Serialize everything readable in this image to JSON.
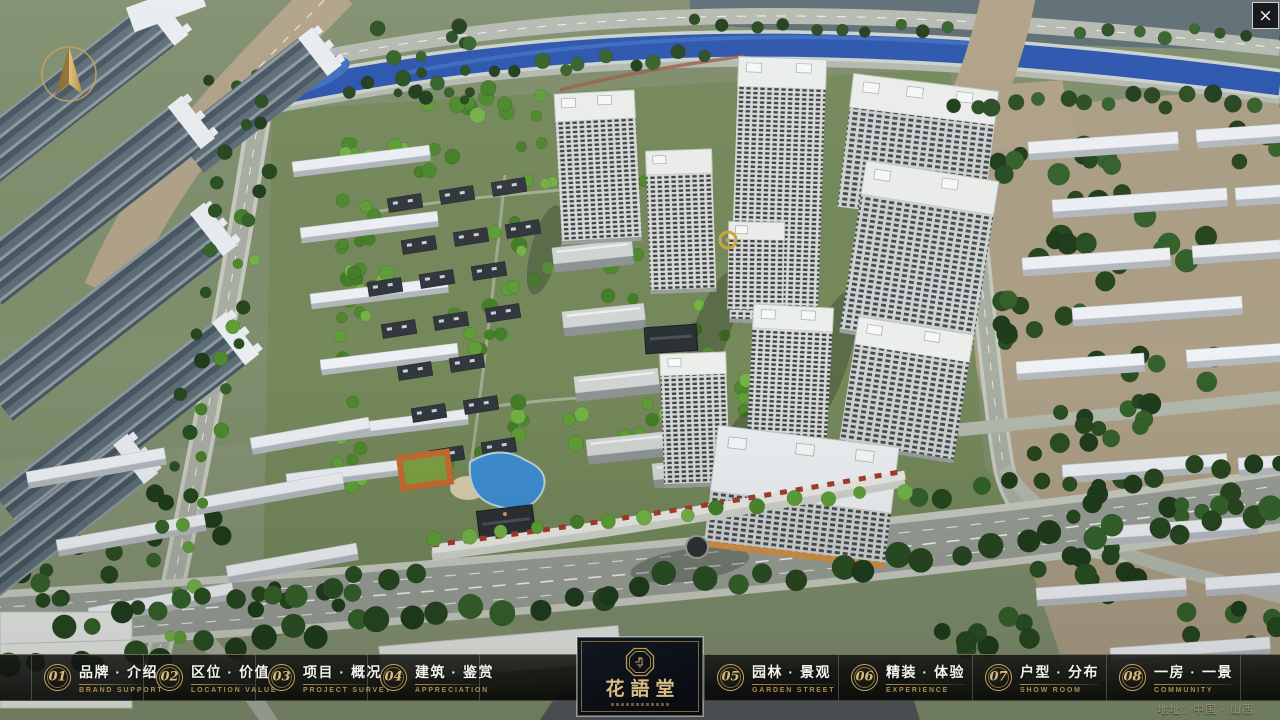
{
  "window": {
    "close_label": "×"
  },
  "logo": {
    "title": "花語堂"
  },
  "nav": {
    "items": [
      {
        "id": "brand-intro",
        "number": "01",
        "zh": "品牌 · 介绍",
        "en": "BRAND SUPPORT",
        "side": "left"
      },
      {
        "id": "location-value",
        "number": "02",
        "zh": "区位 · 价值",
        "en": "LOCATION VALUE",
        "side": "left"
      },
      {
        "id": "project-overview",
        "number": "03",
        "zh": "项目 · 概况",
        "en": "PROJECT SURVEY",
        "side": "left"
      },
      {
        "id": "architecture-appreciation",
        "number": "04",
        "zh": "建筑 · 鉴赏",
        "en": "APPRECIATION",
        "side": "left"
      },
      {
        "id": "garden-landscape",
        "number": "05",
        "zh": "园林 · 景观",
        "en": "GARDEN STREET",
        "side": "right"
      },
      {
        "id": "interior-experience",
        "number": "06",
        "zh": "精装 · 体验",
        "en": "EXPERIENCE",
        "side": "right"
      },
      {
        "id": "unit-distribution",
        "number": "07",
        "zh": "户型 · 分布",
        "en": "SHOW ROOM",
        "side": "right"
      },
      {
        "id": "room-view",
        "number": "08",
        "zh": "一房 · 一景",
        "en": "COMMUNITY",
        "side": "right"
      }
    ]
  },
  "footer": {
    "address": "地址：中国 · 山西"
  },
  "icons": {
    "compass": "north-arrow-icon",
    "emblem": "seal-emblem-icon",
    "close": "close-icon"
  },
  "colors": {
    "gold": "#c9a663",
    "gold_dark": "#ad8d51",
    "text_light": "#f4f3ee",
    "bar_bg": "#0a0c0a",
    "logo_bg": "#0a0e14",
    "river": "#2a55ae",
    "tree_dark": "#2a4f23",
    "tree_bright": "#5f9f38",
    "building_light": "#d9dcd9",
    "road": "#989e95",
    "ground_tan": "#ac9f86"
  }
}
